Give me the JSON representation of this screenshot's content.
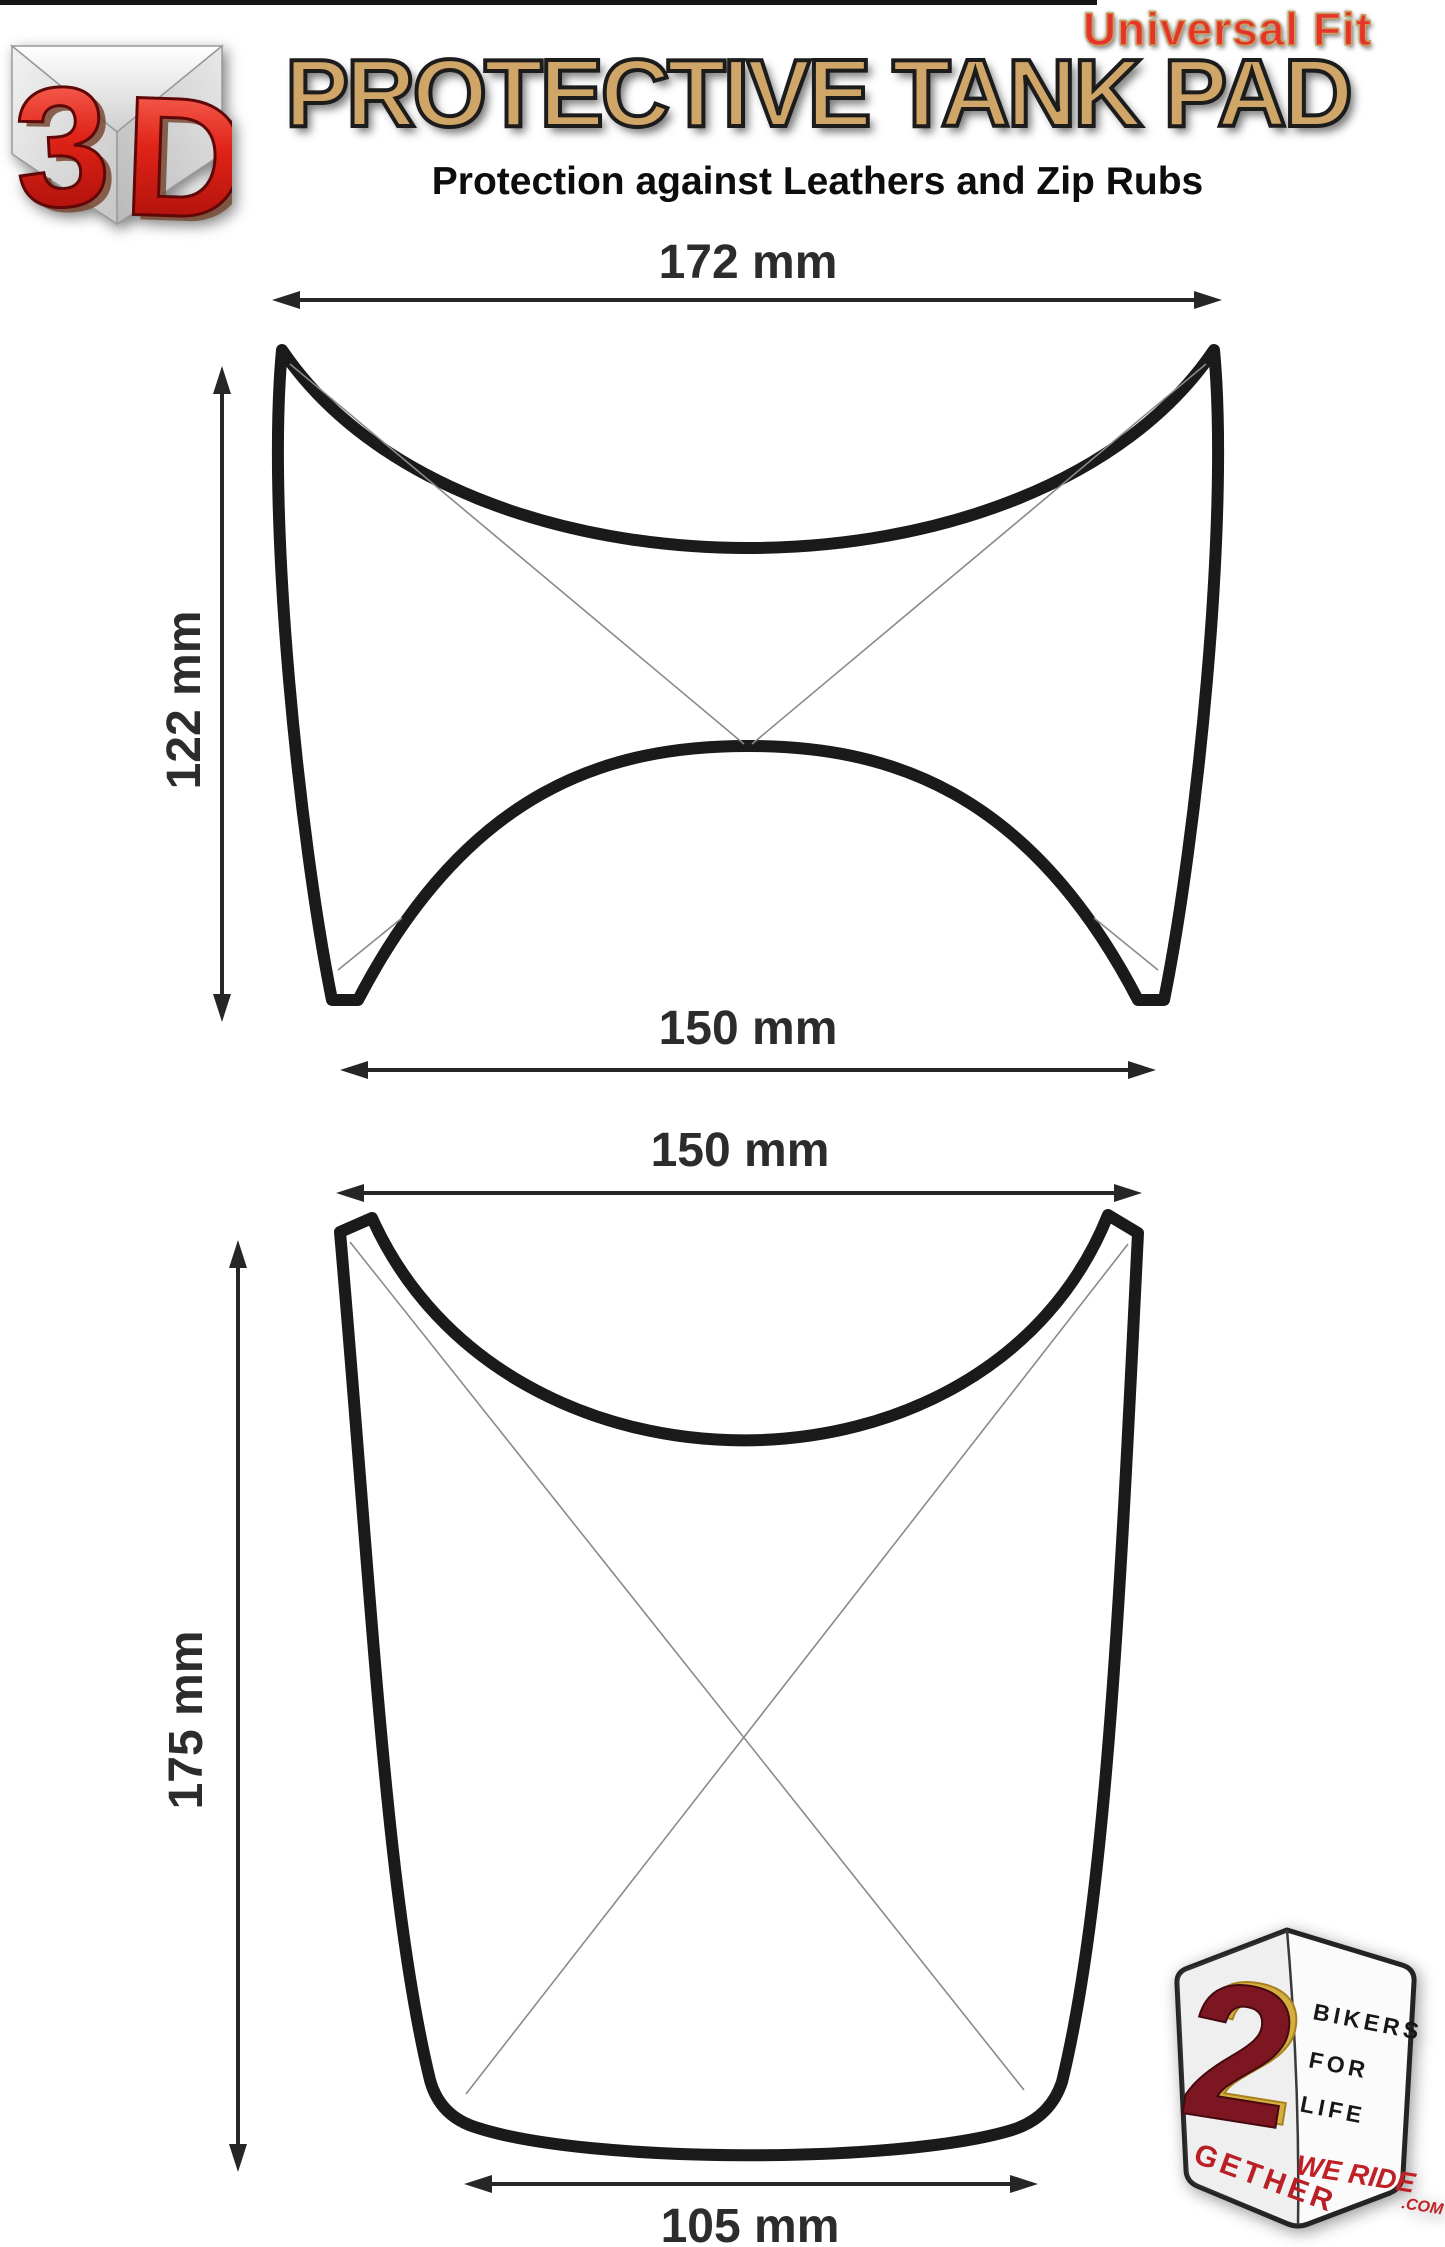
{
  "page": {
    "background": "#ffffff"
  },
  "header": {
    "universal_fit": "Universal Fit",
    "title": "PROTECTIVE TANK PAD",
    "subtitle": "Protection against Leathers and Zip Rubs",
    "logo": {
      "char_3": "3",
      "char_d": "D"
    }
  },
  "drawings": {
    "top_pad": {
      "width": "172 mm",
      "height": "122 mm",
      "bottom_width": "150 mm"
    },
    "bottom_pad": {
      "width": "150 mm",
      "height": "175 mm",
      "bottom_width": "105 mm"
    }
  },
  "badge": {
    "two": "2",
    "gether": "GETHER",
    "bikers": "BIKERS",
    "for": "FOR",
    "life": "LIFE",
    "we_ride": "WE RIDE",
    "com": ".COM"
  },
  "colors": {
    "title_tan": "#cfa668",
    "universal_fit_red": "#e5342b",
    "drawing_line": "#1a1a1a",
    "dimension_text": "#2c2c2c",
    "logo_red": "#d61c1c",
    "badge_maroon": "#7c1620",
    "badge_gold": "#d4af3f",
    "badge_red": "#c02127"
  }
}
